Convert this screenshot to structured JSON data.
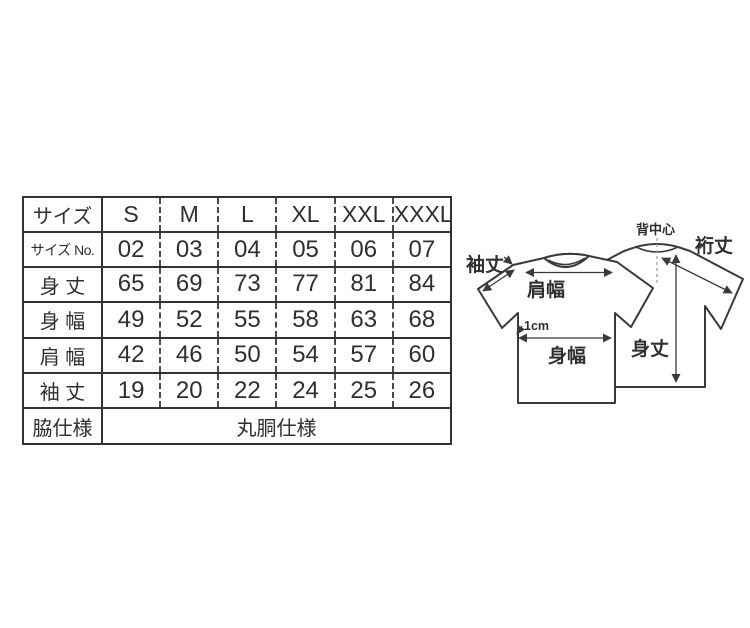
{
  "colors": {
    "background": "#ffffff",
    "ink": "#2f2f2f",
    "table_border": "#333333",
    "line": "#3a3a3a",
    "dashed_guide": "#9a9a9a"
  },
  "size_table": {
    "header": {
      "label": "サイズ",
      "sizes": [
        "S",
        "M",
        "L",
        "XL",
        "XXL",
        "XXXL"
      ]
    },
    "rows": [
      {
        "label": "サイズ No.",
        "values": [
          "02",
          "03",
          "04",
          "05",
          "06",
          "07"
        ]
      },
      {
        "label": "身 丈",
        "values": [
          "65",
          "69",
          "73",
          "77",
          "81",
          "84"
        ]
      },
      {
        "label": "身 幅",
        "values": [
          "49",
          "52",
          "55",
          "58",
          "63",
          "68"
        ]
      },
      {
        "label": "肩 幅",
        "values": [
          "42",
          "46",
          "50",
          "54",
          "57",
          "60"
        ]
      },
      {
        "label": "袖 丈",
        "values": [
          "19",
          "20",
          "22",
          "24",
          "25",
          "26"
        ]
      }
    ],
    "footer": {
      "label": "脇仕様",
      "value": "丸胴仕様"
    }
  },
  "diagram": {
    "labels": {
      "sleeve_length": "袖丈",
      "shoulder_width": "肩幅",
      "underarm_offset": "1cm",
      "body_width": "身幅",
      "back_center": "背中心",
      "yuki_length": "裄丈",
      "body_length": "身丈"
    }
  },
  "chart_data": {
    "type": "table",
    "columns": [
      "サイズ",
      "S",
      "M",
      "L",
      "XL",
      "XXL",
      "XXXL"
    ],
    "rows": [
      [
        "サイズ No.",
        "02",
        "03",
        "04",
        "05",
        "06",
        "07"
      ],
      [
        "身 丈",
        "65",
        "69",
        "73",
        "77",
        "81",
        "84"
      ],
      [
        "身 幅",
        "49",
        "52",
        "55",
        "58",
        "63",
        "68"
      ],
      [
        "肩 幅",
        "42",
        "46",
        "50",
        "54",
        "57",
        "60"
      ],
      [
        "袖 丈",
        "19",
        "20",
        "22",
        "24",
        "25",
        "26"
      ],
      [
        "脇仕様",
        "丸胴仕様"
      ]
    ]
  }
}
